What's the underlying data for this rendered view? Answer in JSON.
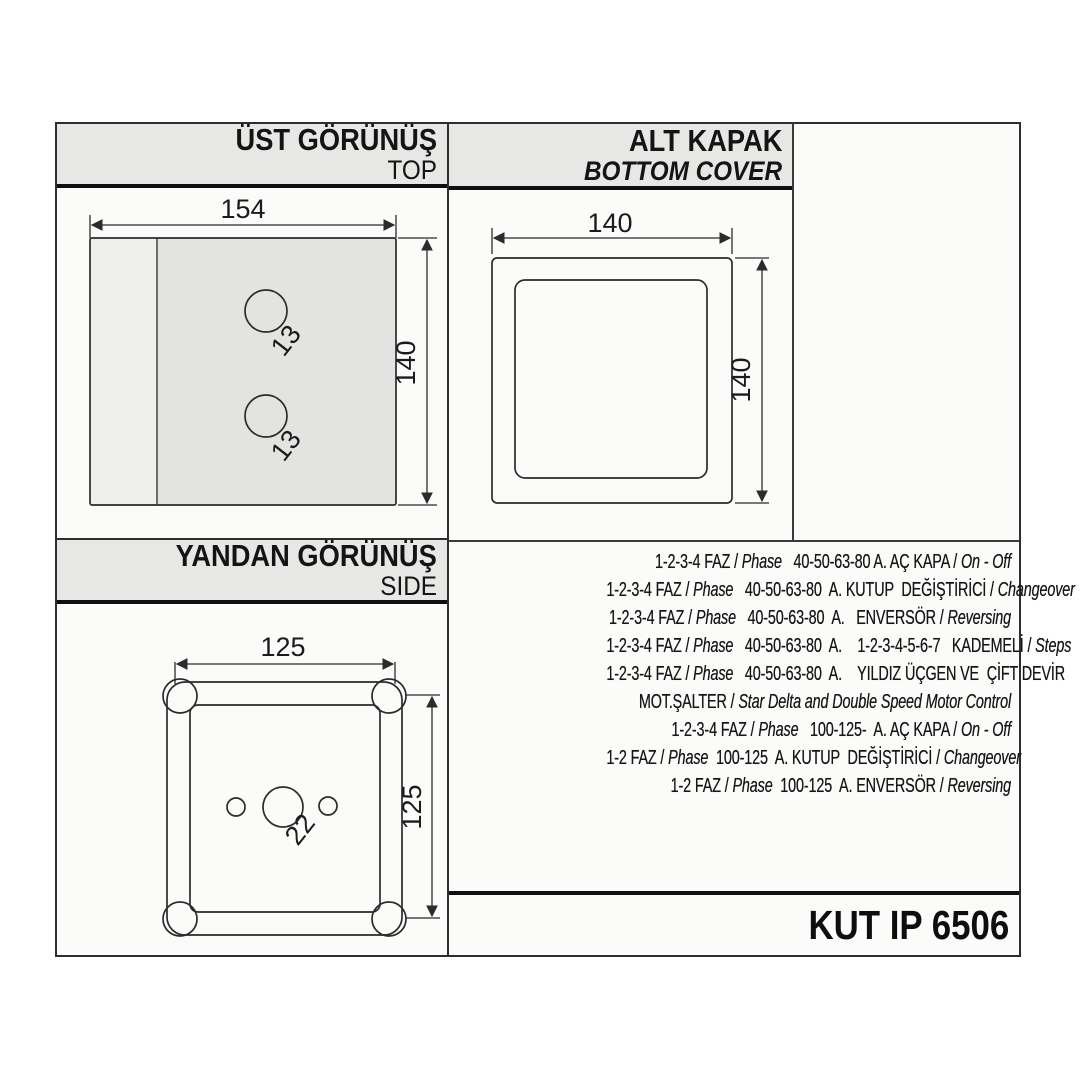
{
  "panels": {
    "top_view": {
      "title": "ÜST GÖRÜNÜŞ",
      "subtitle": "TOP",
      "width_label": "154",
      "height_label": "140",
      "hole_labels": [
        "13",
        "13"
      ]
    },
    "bottom_cover": {
      "title": "ALT KAPAK",
      "subtitle": "BOTTOM COVER",
      "width_label": "140",
      "height_label": "140"
    },
    "side_view": {
      "title": "YANDAN GÖRÜNÜŞ",
      "subtitle": "SIDE",
      "width_label": "125",
      "height_label": "125",
      "hole_label": "22"
    },
    "model": {
      "label": "KUT IP 6506"
    }
  },
  "specs": {
    "lines": [
      {
        "segments": [
          {
            "text": "1-2-3-4 FAZ / ",
            "italic": false
          },
          {
            "text": "Phase",
            "italic": true
          },
          {
            "text": "   40-50-63-80 A. AÇ KAPA / ",
            "italic": false
          },
          {
            "text": "On - Off",
            "italic": true
          }
        ]
      },
      {
        "segments": [
          {
            "text": "1-2-3-4 FAZ / ",
            "italic": false
          },
          {
            "text": "Phase",
            "italic": true
          },
          {
            "text": "   40-50-63-80  A. KUTUP  DEĞİŞTİRİCİ / ",
            "italic": false
          },
          {
            "text": "Changeover",
            "italic": true
          }
        ]
      },
      {
        "segments": [
          {
            "text": "1-2-3-4 FAZ / ",
            "italic": false
          },
          {
            "text": "Phase",
            "italic": true
          },
          {
            "text": "   40-50-63-80  A.   ENVERSÖR / ",
            "italic": false
          },
          {
            "text": "Reversing",
            "italic": true
          }
        ]
      },
      {
        "segments": [
          {
            "text": "1-2-3-4 FAZ / ",
            "italic": false
          },
          {
            "text": "Phase",
            "italic": true
          },
          {
            "text": "   40-50-63-80  A.    1-2-3-4-5-6-7   KADEMELİ / ",
            "italic": false
          },
          {
            "text": "Steps",
            "italic": true
          }
        ]
      },
      {
        "segments": [
          {
            "text": "1-2-3-4 FAZ / ",
            "italic": false
          },
          {
            "text": "Phase",
            "italic": true
          },
          {
            "text": "   40-50-63-80  A.    YILDIZ ÜÇGEN VE  ÇİFT DEVİR",
            "italic": false
          }
        ]
      },
      {
        "segments": [
          {
            "text": "MOT.ŞALTER / ",
            "italic": false
          },
          {
            "text": "Star Delta and Double Speed Motor Control",
            "italic": true
          }
        ]
      },
      {
        "segments": [
          {
            "text": "1-2-3-4 FAZ / ",
            "italic": false
          },
          {
            "text": "Phase",
            "italic": true
          },
          {
            "text": "   100-125-  A. AÇ KAPA / ",
            "italic": false
          },
          {
            "text": "On - Off",
            "italic": true
          }
        ]
      },
      {
        "segments": [
          {
            "text": "1-2 FAZ / ",
            "italic": false
          },
          {
            "text": "Phase",
            "italic": true
          },
          {
            "text": "  100-125  A. KUTUP  DEĞİŞTİRİCİ / ",
            "italic": false
          },
          {
            "text": "Changeover",
            "italic": true
          }
        ]
      },
      {
        "segments": [
          {
            "text": "1-2 FAZ / ",
            "italic": false
          },
          {
            "text": "Phase",
            "italic": true
          },
          {
            "text": "  100-125  A. ENVERSÖR / ",
            "italic": false
          },
          {
            "text": "Reversing",
            "italic": true
          }
        ]
      }
    ]
  },
  "colors": {
    "ink": "#2b2b2b",
    "band_gray": "#e7e7e5",
    "fill_gray": "#e3e3e1",
    "fill_light": "#efefed",
    "fill_inner": "#f6f6f4"
  }
}
